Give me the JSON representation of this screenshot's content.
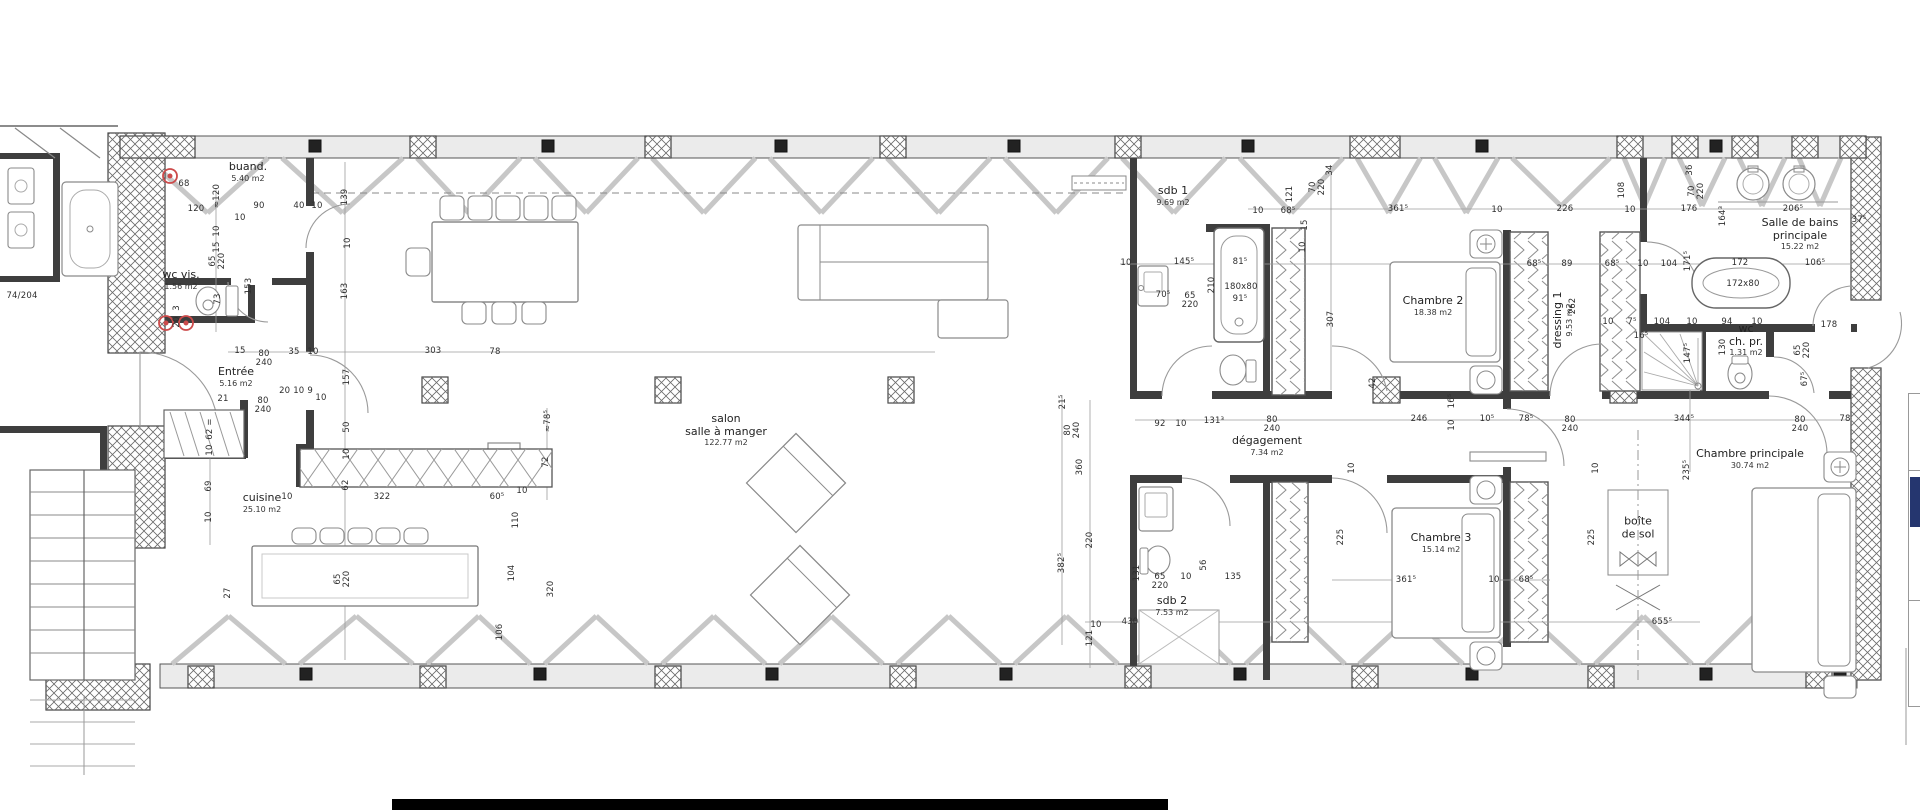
{
  "plan_title": "floor plan",
  "colors": {
    "wall": "#3e3e3e",
    "furniture_line": "#8a8a8a",
    "window": "#c7c7c7",
    "hatch": "#6a6a6a",
    "text": "#2e2e2e",
    "red_symbol": "#cc4b4b",
    "navy": "#25366f",
    "bottom_bar": "#000000",
    "band": "#ebebeb"
  },
  "rooms": [
    {
      "name": [
        "buand."
      ],
      "area": "5.40 m2",
      "x": 248,
      "y": 172
    },
    {
      "name": [
        "wc vis."
      ],
      "area": "1.56 m2",
      "x": 181,
      "y": 280
    },
    {
      "name": [
        "Entrée"
      ],
      "area": "5.16 m2",
      "x": 236,
      "y": 377
    },
    {
      "name": [
        "cuisine"
      ],
      "area": "25.10 m2",
      "x": 262,
      "y": 503
    },
    {
      "name": [
        "salon",
        "salle à manger"
      ],
      "area": "122.77 m2",
      "x": 726,
      "y": 430
    },
    {
      "name": [
        "sdb 1"
      ],
      "area": "9.69 m2",
      "x": 1173,
      "y": 196
    },
    {
      "name": [
        "Chambre 2"
      ],
      "area": "18.38 m2",
      "x": 1433,
      "y": 306
    },
    {
      "name": [
        "dressing 1"
      ],
      "area": "9.53 m2",
      "x": 1563,
      "y": 320,
      "vertical": true
    },
    {
      "name": [
        "Salle de bains",
        "principale"
      ],
      "area": "15.22 m2",
      "x": 1800,
      "y": 234
    },
    {
      "name": [
        "wc",
        "ch. pr."
      ],
      "area": "1.31 m2",
      "x": 1746,
      "y": 340
    },
    {
      "name": [
        "dégagement"
      ],
      "area": "7.34 m2",
      "x": 1267,
      "y": 446
    },
    {
      "name": [
        "Chambre 3"
      ],
      "area": "15.14 m2",
      "x": 1441,
      "y": 543
    },
    {
      "name": [
        "sdb 2"
      ],
      "area": "7.53 m2",
      "x": 1172,
      "y": 606
    },
    {
      "name": [
        "Chambre principale"
      ],
      "area": "30.74 m2",
      "x": 1750,
      "y": 459
    },
    {
      "name": [
        "boîte",
        "de sol"
      ],
      "area": "",
      "x": 1638,
      "y": 528
    }
  ],
  "fixture_labels": [
    {
      "t": "180x80",
      "x": 1241,
      "y": 287
    },
    {
      "t": "172x80",
      "x": 1743,
      "y": 284
    },
    {
      "t": "74/204",
      "x": 22,
      "y": 296
    }
  ],
  "dims": [
    {
      "t": "68",
      "x": 184,
      "y": 184
    },
    {
      "t": "120",
      "x": 196,
      "y": 209
    },
    {
      "t": "≈120",
      "x": 217,
      "y": 196,
      "v": 1
    },
    {
      "t": "90",
      "x": 259,
      "y": 206
    },
    {
      "t": "40",
      "x": 299,
      "y": 206
    },
    {
      "t": "10",
      "x": 317,
      "y": 206
    },
    {
      "t": "10",
      "x": 240,
      "y": 218
    },
    {
      "t": "139",
      "x": 345,
      "y": 197,
      "v": 1
    },
    {
      "t": "10",
      "x": 217,
      "y": 231,
      "v": 1
    },
    {
      "t": "15",
      "x": 217,
      "y": 247,
      "v": 1
    },
    {
      "t": "65",
      "x": 213,
      "y": 261,
      "v": 1
    },
    {
      "t": "220",
      "x": 222,
      "y": 261,
      "v": 1
    },
    {
      "t": "153",
      "x": 249,
      "y": 286,
      "v": 1
    },
    {
      "t": "10",
      "x": 348,
      "y": 243,
      "v": 1
    },
    {
      "t": "163",
      "x": 345,
      "y": 291,
      "v": 1
    },
    {
      "t": "73",
      "x": 218,
      "y": 299,
      "v": 1
    },
    {
      "t": "3",
      "x": 177,
      "y": 308,
      "v": 1
    },
    {
      "t": "20",
      "x": 177,
      "y": 322,
      "v": 1
    },
    {
      "t": "15",
      "x": 240,
      "y": 351
    },
    {
      "t": "80",
      "x": 264,
      "y": 354
    },
    {
      "t": "240",
      "x": 264,
      "y": 363
    },
    {
      "t": "35",
      "x": 294,
      "y": 352
    },
    {
      "t": "10",
      "x": 313,
      "y": 352
    },
    {
      "t": "303",
      "x": 433,
      "y": 351
    },
    {
      "t": "78",
      "x": 495,
      "y": 352
    },
    {
      "t": "157",
      "x": 347,
      "y": 377,
      "v": 1
    },
    {
      "t": "21",
      "x": 223,
      "y": 399
    },
    {
      "t": "80",
      "x": 263,
      "y": 401
    },
    {
      "t": "240",
      "x": 263,
      "y": 410
    },
    {
      "t": "20  10  9",
      "x": 296,
      "y": 391
    },
    {
      "t": "10",
      "x": 321,
      "y": 398
    },
    {
      "t": "10",
      "x": 287,
      "y": 497
    },
    {
      "t": "62 =",
      "x": 210,
      "y": 429,
      "v": 1
    },
    {
      "t": "10",
      "x": 210,
      "y": 450,
      "v": 1
    },
    {
      "t": "69",
      "x": 209,
      "y": 486,
      "v": 1
    },
    {
      "t": "10",
      "x": 209,
      "y": 517,
      "v": 1
    },
    {
      "t": "50",
      "x": 347,
      "y": 427,
      "v": 1
    },
    {
      "t": "10",
      "x": 347,
      "y": 454,
      "v": 1
    },
    {
      "t": "62",
      "x": 346,
      "y": 485,
      "v": 1
    },
    {
      "t": "322",
      "x": 382,
      "y": 497
    },
    {
      "t": "60⁵",
      "x": 497,
      "y": 497
    },
    {
      "t": "10",
      "x": 522,
      "y": 491
    },
    {
      "t": "110",
      "x": 516,
      "y": 520,
      "v": 1
    },
    {
      "t": "104",
      "x": 512,
      "y": 573,
      "v": 1
    },
    {
      "t": "320",
      "x": 551,
      "y": 589,
      "v": 1
    },
    {
      "t": "106",
      "x": 500,
      "y": 632,
      "v": 1
    },
    {
      "t": "27",
      "x": 228,
      "y": 593,
      "v": 1
    },
    {
      "t": "65",
      "x": 338,
      "y": 579,
      "v": 1
    },
    {
      "t": "220",
      "x": 347,
      "y": 579,
      "v": 1
    },
    {
      "t": "72",
      "x": 546,
      "y": 462,
      "v": 1
    },
    {
      "t": "≈78⁵",
      "x": 548,
      "y": 421,
      "v": 1
    },
    {
      "t": "121",
      "x": 1290,
      "y": 194,
      "v": 1
    },
    {
      "t": "10",
      "x": 1258,
      "y": 211
    },
    {
      "t": "68⁵",
      "x": 1288,
      "y": 211
    },
    {
      "t": "34",
      "x": 1330,
      "y": 170,
      "v": 1
    },
    {
      "t": "70",
      "x": 1313,
      "y": 187,
      "v": 1
    },
    {
      "t": "220",
      "x": 1322,
      "y": 187,
      "v": 1
    },
    {
      "t": "15",
      "x": 1305,
      "y": 225,
      "v": 1
    },
    {
      "t": "10",
      "x": 1303,
      "y": 247,
      "v": 1
    },
    {
      "t": "361⁵",
      "x": 1398,
      "y": 209
    },
    {
      "t": "10",
      "x": 1497,
      "y": 210
    },
    {
      "t": "226",
      "x": 1565,
      "y": 209
    },
    {
      "t": "10",
      "x": 1630,
      "y": 210
    },
    {
      "t": "176",
      "x": 1689,
      "y": 209
    },
    {
      "t": "206⁵",
      "x": 1793,
      "y": 209
    },
    {
      "t": "36",
      "x": 1690,
      "y": 170,
      "v": 1
    },
    {
      "t": "70",
      "x": 1692,
      "y": 191,
      "v": 1
    },
    {
      "t": "220",
      "x": 1701,
      "y": 191,
      "v": 1
    },
    {
      "t": "108",
      "x": 1622,
      "y": 190,
      "v": 1
    },
    {
      "t": "164³",
      "x": 1723,
      "y": 216,
      "v": 1
    },
    {
      "t": "37⁵",
      "x": 1859,
      "y": 220
    },
    {
      "t": "10",
      "x": 1126,
      "y": 263
    },
    {
      "t": "145⁵",
      "x": 1184,
      "y": 262
    },
    {
      "t": "81⁵",
      "x": 1240,
      "y": 262
    },
    {
      "t": "210",
      "x": 1212,
      "y": 285,
      "v": 1
    },
    {
      "t": "70⁵",
      "x": 1163,
      "y": 295
    },
    {
      "t": "65",
      "x": 1190,
      "y": 296
    },
    {
      "t": "220",
      "x": 1190,
      "y": 305
    },
    {
      "t": "91⁵",
      "x": 1240,
      "y": 299
    },
    {
      "t": "307",
      "x": 1331,
      "y": 319,
      "v": 1
    },
    {
      "t": "68⁵",
      "x": 1534,
      "y": 264
    },
    {
      "t": "89",
      "x": 1567,
      "y": 264
    },
    {
      "t": "68⁵",
      "x": 1612,
      "y": 264
    },
    {
      "t": "10",
      "x": 1643,
      "y": 264
    },
    {
      "t": "104",
      "x": 1669,
      "y": 264
    },
    {
      "t": "171⁵",
      "x": 1688,
      "y": 261,
      "v": 1
    },
    {
      "t": "172",
      "x": 1740,
      "y": 263
    },
    {
      "t": "106⁵",
      "x": 1815,
      "y": 263
    },
    {
      "t": "262",
      "x": 1573,
      "y": 306,
      "v": 1
    },
    {
      "t": "10",
      "x": 1608,
      "y": 322
    },
    {
      "t": "7⁵",
      "x": 1632,
      "y": 322
    },
    {
      "t": "104",
      "x": 1662,
      "y": 322
    },
    {
      "t": "10",
      "x": 1692,
      "y": 322
    },
    {
      "t": "94",
      "x": 1727,
      "y": 322
    },
    {
      "t": "10",
      "x": 1757,
      "y": 322
    },
    {
      "t": "16⁵",
      "x": 1641,
      "y": 336
    },
    {
      "t": "130",
      "x": 1723,
      "y": 347,
      "v": 1
    },
    {
      "t": "147⁵",
      "x": 1688,
      "y": 353,
      "v": 1
    },
    {
      "t": "65",
      "x": 1798,
      "y": 350,
      "v": 1
    },
    {
      "t": "220",
      "x": 1807,
      "y": 350,
      "v": 1
    },
    {
      "t": "178",
      "x": 1829,
      "y": 325
    },
    {
      "t": "67⁵",
      "x": 1805,
      "y": 379,
      "v": 1
    },
    {
      "t": "92",
      "x": 1160,
      "y": 424
    },
    {
      "t": "10",
      "x": 1181,
      "y": 424
    },
    {
      "t": "131³",
      "x": 1214,
      "y": 421
    },
    {
      "t": "80",
      "x": 1272,
      "y": 420
    },
    {
      "t": "240",
      "x": 1272,
      "y": 429
    },
    {
      "t": "246",
      "x": 1419,
      "y": 419
    },
    {
      "t": "10⁵",
      "x": 1487,
      "y": 419
    },
    {
      "t": "78⁵",
      "x": 1526,
      "y": 419
    },
    {
      "t": "80",
      "x": 1570,
      "y": 420
    },
    {
      "t": "240",
      "x": 1570,
      "y": 429
    },
    {
      "t": "344⁵",
      "x": 1684,
      "y": 419
    },
    {
      "t": "80",
      "x": 1800,
      "y": 420
    },
    {
      "t": "240",
      "x": 1800,
      "y": 429
    },
    {
      "t": "78",
      "x": 1845,
      "y": 419
    },
    {
      "t": "16⁵",
      "x": 1452,
      "y": 401,
      "v": 1
    },
    {
      "t": "10",
      "x": 1452,
      "y": 425,
      "v": 1
    },
    {
      "t": "42",
      "x": 1373,
      "y": 383,
      "v": 1
    },
    {
      "t": "21⁵",
      "x": 1063,
      "y": 402,
      "v": 1
    },
    {
      "t": "80",
      "x": 1068,
      "y": 430,
      "v": 1
    },
    {
      "t": "240",
      "x": 1077,
      "y": 430,
      "v": 1
    },
    {
      "t": "360",
      "x": 1080,
      "y": 467,
      "v": 1
    },
    {
      "t": "382⁵",
      "x": 1062,
      "y": 563,
      "v": 1
    },
    {
      "t": "220",
      "x": 1090,
      "y": 540,
      "v": 1
    },
    {
      "t": "121",
      "x": 1090,
      "y": 638,
      "v": 1
    },
    {
      "t": "131",
      "x": 1137,
      "y": 573,
      "v": 1
    },
    {
      "t": "65",
      "x": 1160,
      "y": 577
    },
    {
      "t": "220",
      "x": 1160,
      "y": 586
    },
    {
      "t": "10",
      "x": 1186,
      "y": 577
    },
    {
      "t": "56",
      "x": 1204,
      "y": 565,
      "v": 1
    },
    {
      "t": "135",
      "x": 1233,
      "y": 577
    },
    {
      "t": "225",
      "x": 1341,
      "y": 537,
      "v": 1
    },
    {
      "t": "225",
      "x": 1592,
      "y": 537,
      "v": 1
    },
    {
      "t": "10",
      "x": 1352,
      "y": 468,
      "v": 1
    },
    {
      "t": "10",
      "x": 1596,
      "y": 468,
      "v": 1
    },
    {
      "t": "361⁵",
      "x": 1406,
      "y": 580
    },
    {
      "t": "10",
      "x": 1494,
      "y": 580
    },
    {
      "t": "68⁵",
      "x": 1526,
      "y": 580
    },
    {
      "t": "235⁵",
      "x": 1687,
      "y": 470,
      "v": 1
    },
    {
      "t": "655⁵",
      "x": 1662,
      "y": 622
    },
    {
      "t": "430",
      "x": 1130,
      "y": 622
    },
    {
      "t": "10",
      "x": 1096,
      "y": 625
    }
  ],
  "legend": {
    "note_lines": 3
  }
}
